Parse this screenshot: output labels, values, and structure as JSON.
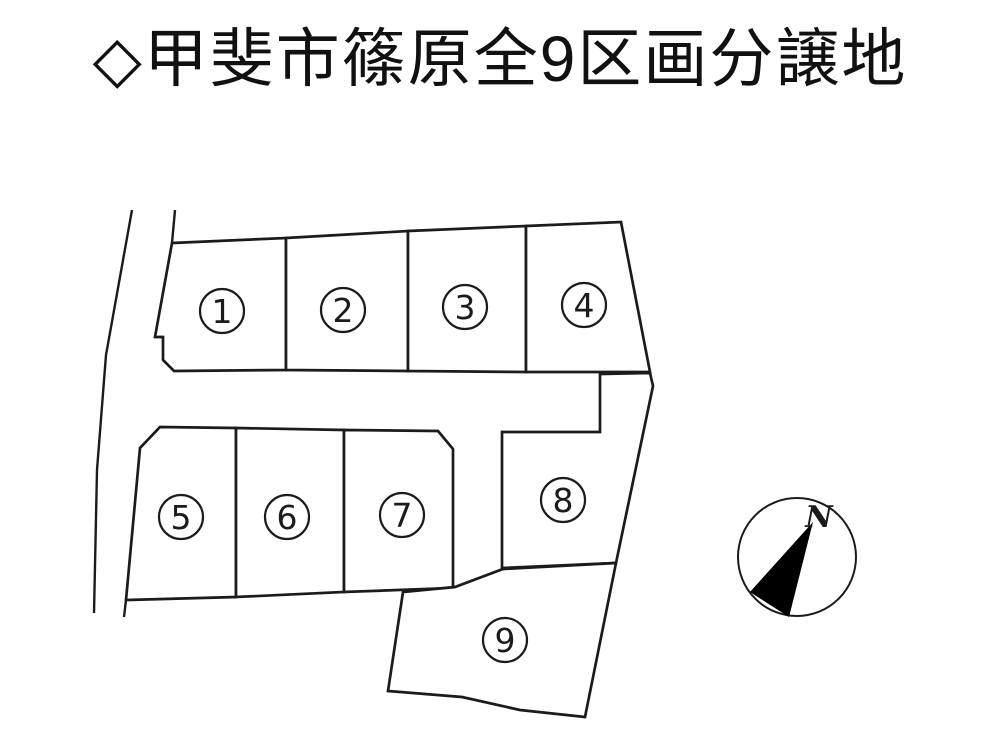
{
  "page": {
    "background": "#ffffff",
    "width": 1000,
    "height": 750
  },
  "title": {
    "text": "◇甲斐市篠原全9区画分譲地",
    "color": "#111111"
  },
  "colors": {
    "line": "#1b1b1b",
    "lot_fill": "#ffffff",
    "needle_fill": "#000000"
  },
  "diagram": {
    "lot_stroke_width": 2.7,
    "road_stroke_width": 2.4,
    "label_radius": 22,
    "label_circle_stroke_width": 2.2,
    "label_font_size": 33,
    "lots": [
      {
        "number": "1",
        "label": {
          "x": 222,
          "y": 311
        },
        "polygon": [
          [
            172,
            243
          ],
          [
            286,
            238
          ],
          [
            286,
            370
          ],
          [
            174,
            371
          ],
          [
            163,
            360
          ],
          [
            163,
            337
          ],
          [
            155,
            337
          ]
        ]
      },
      {
        "number": "2",
        "label": {
          "x": 343,
          "y": 310
        },
        "polygon": [
          [
            286,
            238
          ],
          [
            408,
            231
          ],
          [
            408,
            371
          ],
          [
            286,
            370
          ]
        ]
      },
      {
        "number": "3",
        "label": {
          "x": 465,
          "y": 307
        },
        "polygon": [
          [
            408,
            231
          ],
          [
            526,
            226
          ],
          [
            526,
            372
          ],
          [
            408,
            371
          ]
        ]
      },
      {
        "number": "4",
        "label": {
          "x": 584,
          "y": 305
        },
        "polygon": [
          [
            526,
            226
          ],
          [
            621,
            222
          ],
          [
            650,
            372
          ],
          [
            526,
            372
          ]
        ]
      },
      {
        "number": "5",
        "label": {
          "x": 181,
          "y": 517
        },
        "polygon": [
          [
            160,
            427
          ],
          [
            236,
            428
          ],
          [
            236,
            597
          ],
          [
            126,
            600
          ],
          [
            140,
            448
          ]
        ]
      },
      {
        "number": "6",
        "label": {
          "x": 287,
          "y": 517
        },
        "polygon": [
          [
            236,
            428
          ],
          [
            344,
            430
          ],
          [
            344,
            592
          ],
          [
            236,
            597
          ]
        ]
      },
      {
        "number": "7",
        "label": {
          "x": 402,
          "y": 515
        },
        "polygon": [
          [
            344,
            430
          ],
          [
            438,
            431
          ],
          [
            453,
            449
          ],
          [
            453,
            588
          ],
          [
            344,
            592
          ]
        ]
      },
      {
        "number": "8",
        "label": {
          "x": 563,
          "y": 500
        },
        "polygon": [
          [
            600,
            374
          ],
          [
            650,
            373
          ],
          [
            653,
            386
          ],
          [
            616,
            563
          ],
          [
            502,
            568
          ],
          [
            502,
            432
          ],
          [
            600,
            432
          ]
        ]
      },
      {
        "number": "9",
        "label": {
          "x": 505,
          "y": 640
        },
        "polygon": [
          [
            403,
            592
          ],
          [
            455,
            587
          ],
          [
            503,
            569
          ],
          [
            616,
            563
          ],
          [
            585,
            717
          ],
          [
            520,
            710
          ],
          [
            462,
            697
          ],
          [
            388,
            691
          ]
        ]
      }
    ],
    "road_lines": [
      {
        "name": "left-road-outer-line",
        "points": [
          [
            132,
            210
          ],
          [
            106,
            355
          ],
          [
            97,
            470
          ],
          [
            94,
            613
          ]
        ]
      },
      {
        "name": "left-road-inner-line",
        "points": [
          [
            175,
            210
          ],
          [
            172,
            243
          ]
        ]
      },
      {
        "name": "lot5-left-edge-tail",
        "points": [
          [
            126,
            600
          ],
          [
            124,
            617
          ]
        ]
      }
    ]
  },
  "compass": {
    "label": "N",
    "cx": 797,
    "cy": 557,
    "r": 59,
    "circle_stroke_width": 2,
    "needle": [
      [
        813,
        522
      ],
      [
        750,
        592
      ],
      [
        789,
        617
      ]
    ],
    "label_x": 819,
    "label_y": 527,
    "label_font_size": 30
  }
}
